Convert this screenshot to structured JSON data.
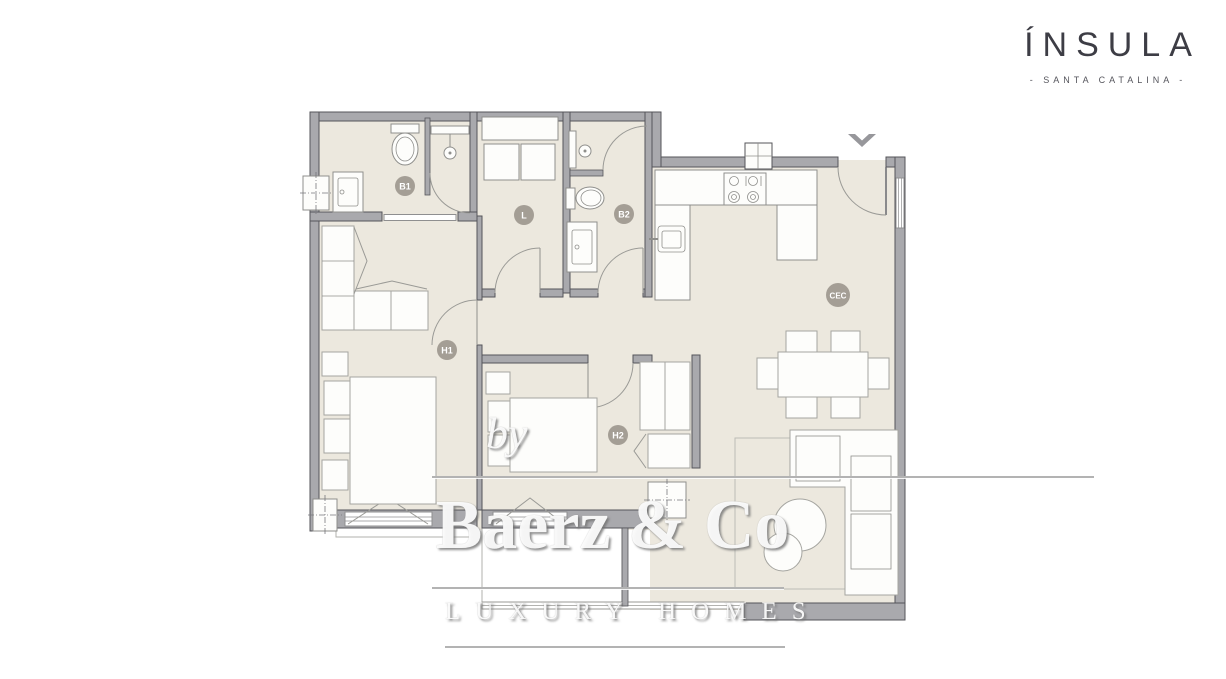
{
  "branding": {
    "name": "ÍNSULA",
    "tagline": "- SANTA CATALINA -"
  },
  "watermark": {
    "prefix": "by",
    "brand": "Baerz & Co",
    "tagline": "LUXURY HOMES"
  },
  "plan": {
    "type": "apartment-floor-plan",
    "room_labels": [
      {
        "id": "b1",
        "label": "B1"
      },
      {
        "id": "l",
        "label": "L"
      },
      {
        "id": "b2",
        "label": "B2"
      },
      {
        "id": "h1",
        "label": "H1"
      },
      {
        "id": "h2",
        "label": "H2"
      },
      {
        "id": "cec",
        "label": "CEC"
      }
    ]
  },
  "colors": {
    "floor": "#ece8de",
    "wall": "#a9a9ad",
    "wall_edge": "#55555a",
    "label_badge": "#a49e95",
    "logo_text": "#3d3d45"
  }
}
